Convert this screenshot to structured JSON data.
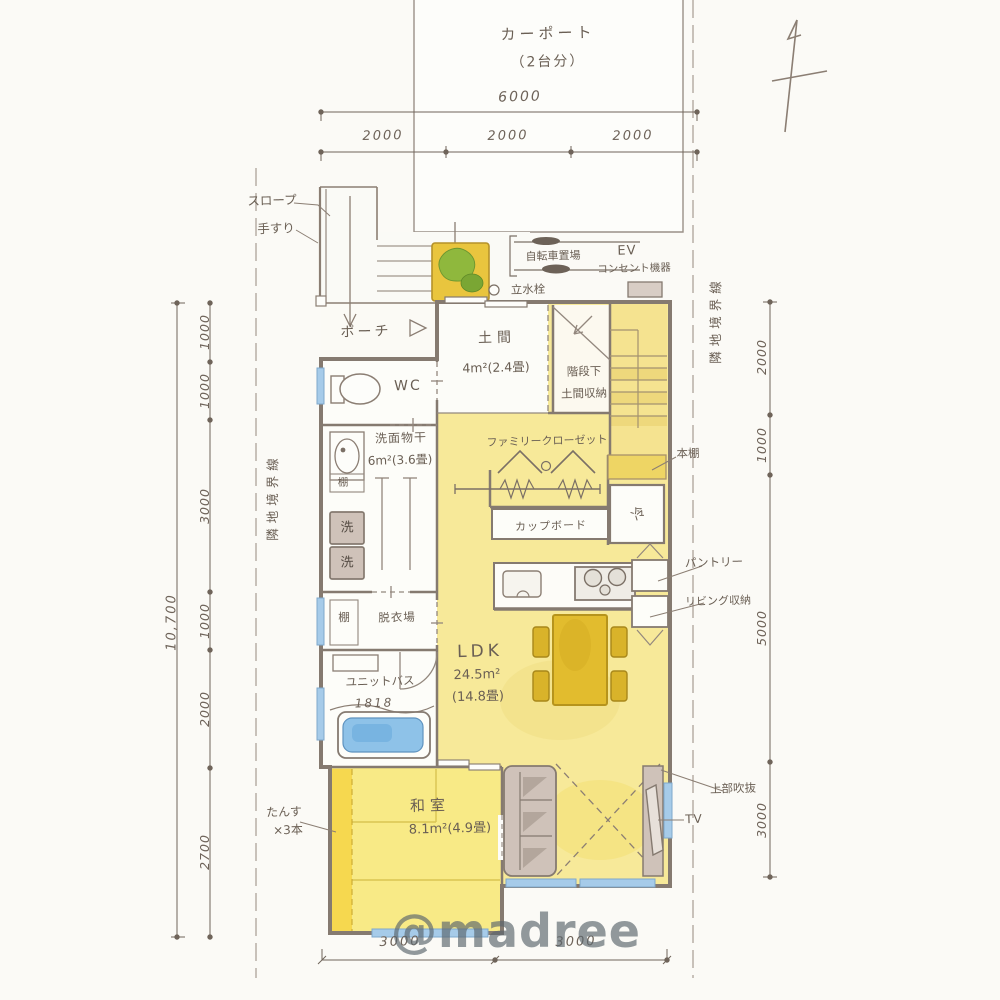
{
  "watermark": "@madree",
  "carport": {
    "label": "カーポート",
    "capacity": "（2台分）"
  },
  "site": {
    "boundary_left": "隣地境界線",
    "boundary_right": "隣地境界線"
  },
  "approach": {
    "slope": "スロープ",
    "handrail": "手すり",
    "porch": "ポーチ"
  },
  "exterior": {
    "bicycle_parking": "自転車置場",
    "ev_line1": "EV",
    "ev_line2": "コンセント機器",
    "standpipe": "立水栓"
  },
  "entrance": {
    "doma": "土間",
    "doma_area": "4m²(2.4畳)",
    "understairs_line1": "階段下",
    "understairs_line2": "土間収納"
  },
  "sanitary": {
    "wc": "WC",
    "washroom": "洗面物干",
    "washroom_area": "6m²(3.6畳)",
    "shelf_upper": "棚",
    "washer_top": "洗",
    "washer_bottom": "洗",
    "shelf_lower": "棚",
    "dressing_room": "脱衣場",
    "unit_bath": "ユニットバス",
    "unit_bath_size": "1818"
  },
  "storage": {
    "family_closet": "ファミリークローゼット",
    "bookshelf": "本棚",
    "refrigerator": "冷",
    "cupboard": "カップボード",
    "pantry": "パントリー",
    "living_storage": "リビング収納"
  },
  "living": {
    "name": "LDK",
    "area": "24.5m²",
    "tatami": "(14.8畳)",
    "void_above": "上部吹抜",
    "tv": "TV"
  },
  "washitsu": {
    "name": "和室",
    "area": "8.1m²(4.9畳)",
    "tansu_line1": "たんす",
    "tansu_line2": "×3本"
  },
  "dimensions": {
    "top_total": "6000",
    "top_segments": [
      "2000",
      "2000",
      "2000"
    ],
    "left_total": "10,700",
    "left_segments": [
      "1000",
      "1000",
      "3000",
      "1000",
      "2000",
      "2700"
    ],
    "right_segments": [
      "2000",
      "1000",
      "5000",
      "3000"
    ],
    "bottom_segments": [
      "3000",
      "3000"
    ]
  },
  "colors": {
    "room_yellow": "#f7e999",
    "tatami_yellow": "#f8ea86",
    "furniture_gray": "#cfc2b9",
    "window_blue": "#a6cbe9",
    "ink": "#857a70",
    "accent_table": "#e2bc2e"
  }
}
